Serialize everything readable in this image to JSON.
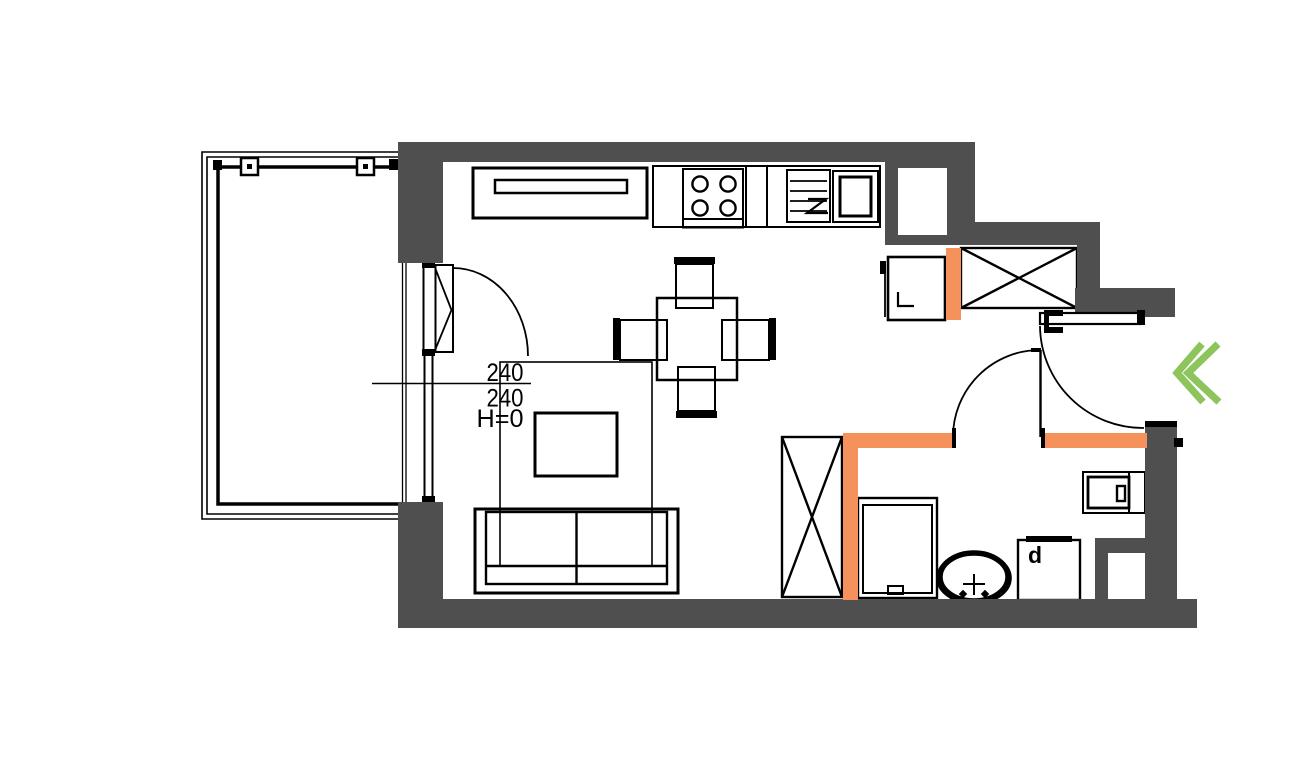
{
  "page": {
    "background": "#ffffff"
  },
  "colors": {
    "wall_fill": "#4f4f4f",
    "highlight_wall": "#f5915a",
    "entrance_marker": "#8dc45c",
    "line": "#000000"
  },
  "annotations": {
    "window_dimension": {
      "top_value": "240",
      "bottom_value": "240",
      "height_note": "H=0"
    }
  },
  "labels": {
    "washer": "d"
  }
}
